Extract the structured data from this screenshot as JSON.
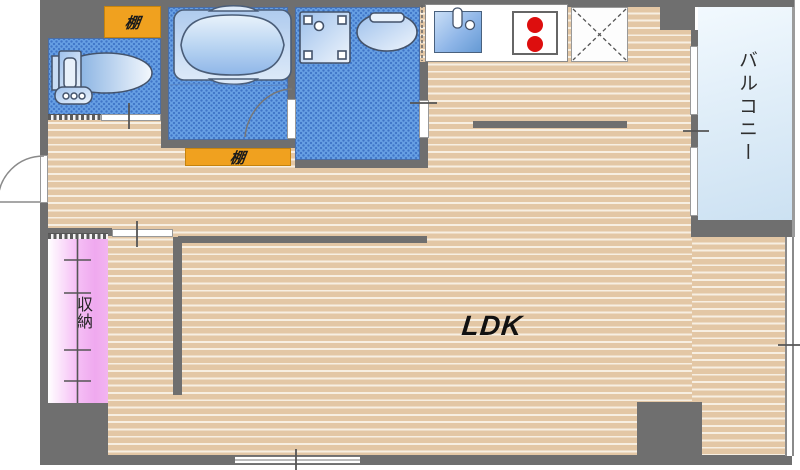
{
  "plan": {
    "type": "apartment-floor-plan",
    "labels": {
      "ldk": "LDK",
      "balcony": "バルコニー",
      "storage": "収納",
      "shelf_top": "棚",
      "shelf_bottom": "棚"
    },
    "colors": {
      "wall_gray": "#6F6F6F",
      "wood_floor_tan": "#E3C7A5",
      "wood_stripe_light": "#F7EFE2",
      "wet_area_blue": "#67A0E4",
      "wet_area_dot_blue": "#4076C8",
      "shelf_orange": "#F0A11F",
      "storage_pink": "#EFA9EF",
      "balcony_blue": "#CCE1F2",
      "burner_red": "#DD0E0E",
      "fixture_blue": "#8FB8EA"
    },
    "fixtures": [
      "toilet",
      "bathtub",
      "washing-machine-space",
      "wash-basin",
      "kitchen-sink",
      "two-burner-stove",
      "refrigerator-space"
    ]
  }
}
